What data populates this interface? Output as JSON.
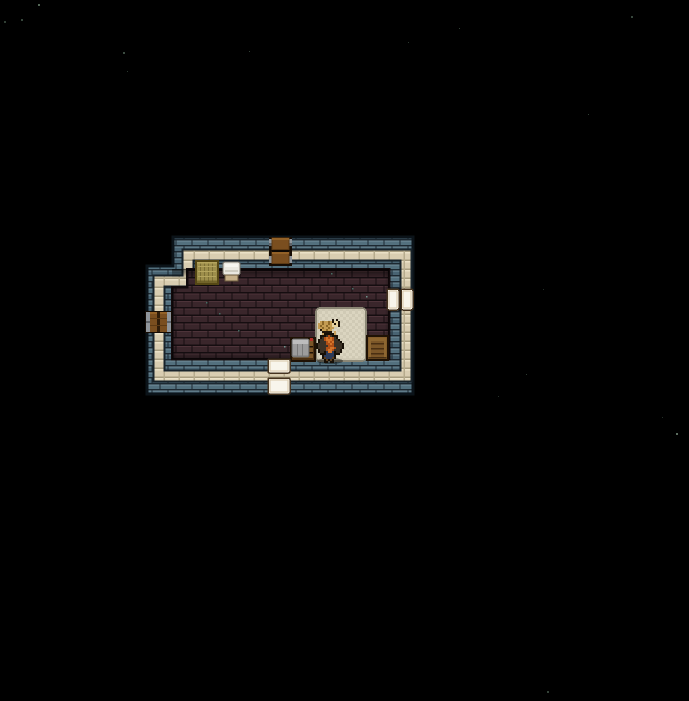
{
  "scene": {
    "background": "#000000",
    "stars": [
      {
        "x": 38,
        "y": 4,
        "s": 2,
        "c": "#5d7261",
        "o": 0.9
      },
      {
        "x": 21,
        "y": 19,
        "s": 2,
        "c": "#44584a",
        "o": 0.8
      },
      {
        "x": 4,
        "y": 21,
        "s": 2,
        "c": "#44584a",
        "o": 0.7
      },
      {
        "x": 123,
        "y": 52,
        "s": 2,
        "c": "#4a5e50",
        "o": 0.8
      },
      {
        "x": 249,
        "y": 51,
        "s": 1,
        "c": "#44584a",
        "o": 0.7
      },
      {
        "x": 127,
        "y": 71,
        "s": 1,
        "c": "#3c4f42",
        "o": 0.7
      },
      {
        "x": 459,
        "y": 28,
        "s": 1,
        "c": "#44584a",
        "o": 0.7
      },
      {
        "x": 631,
        "y": 16,
        "s": 2,
        "c": "#4a5e50",
        "o": 0.75
      },
      {
        "x": 408,
        "y": 42,
        "s": 1,
        "c": "#3c4f42",
        "o": 0.7
      },
      {
        "x": 588,
        "y": 114,
        "s": 1,
        "c": "#44584a",
        "o": 0.7
      },
      {
        "x": 543,
        "y": 289,
        "s": 1,
        "c": "#3c4f42",
        "o": 0.6
      },
      {
        "x": 526,
        "y": 374,
        "s": 1,
        "c": "#44584a",
        "o": 0.65
      },
      {
        "x": 498,
        "y": 396,
        "s": 1,
        "c": "#3c4f42",
        "o": 0.6
      },
      {
        "x": 676,
        "y": 433,
        "s": 2,
        "c": "#6b7f70",
        "o": 0.85
      },
      {
        "x": 662,
        "y": 417,
        "s": 1,
        "c": "#3c4f42",
        "o": 0.6
      },
      {
        "x": 547,
        "y": 691,
        "s": 2,
        "c": "#4a5e50",
        "o": 0.7
      }
    ],
    "room": {
      "outer_polygon": [
        [
          173,
          237
        ],
        [
          413,
          237
        ],
        [
          413,
          394
        ],
        [
          147,
          394
        ],
        [
          147,
          266
        ],
        [
          173,
          266
        ]
      ],
      "beige_ring": [
        [
          188,
          255
        ],
        [
          406,
          255
        ],
        [
          406,
          376
        ],
        [
          159,
          376
        ],
        [
          159,
          281
        ],
        [
          188,
          281
        ]
      ],
      "floor_path": "M187,269 L389,269 L389,359 L172,359 L172,287 L187,287 Z",
      "floor_specks": [
        {
          "x": 219,
          "y": 313,
          "c": "#4b7a70"
        },
        {
          "x": 284,
          "y": 346,
          "c": "#79a89e"
        },
        {
          "x": 331,
          "y": 273,
          "c": "#4b7a70"
        },
        {
          "x": 352,
          "y": 288,
          "c": "#4b7a70"
        },
        {
          "x": 366,
          "y": 296,
          "c": "#79a89e"
        },
        {
          "x": 206,
          "y": 302,
          "c": "#4b7a70"
        },
        {
          "x": 238,
          "y": 330,
          "c": "#4b7a70"
        }
      ],
      "palette": {
        "outline": "#0b1319",
        "wall_mortar": "#1c2831",
        "wall_brick": "#53707e",
        "wall_brick2": "#486372",
        "wall_brick_hi": "#74919d",
        "ring_dark": "#18232b",
        "beige": "#d9cdb1",
        "beige_hi": "#ebe1c7",
        "beige_lo": "#a89d80",
        "beige_line": "#b6ab8d",
        "floor_mortar": "#150d10",
        "floor_brick": "#3a262b",
        "floor_brick_hi": "#4d3339",
        "floor_edge": "#120a0c",
        "wood_dark": "#150c04",
        "wood": "#7a4e1f",
        "wood_hi": "#936127",
        "wood_line": "#5d3a14",
        "metal": "#8f959b",
        "metal_dark": "#5d6268",
        "white_door": "#f8f5ec",
        "door_frame": "#45331f",
        "door_inner": "#d8c7a9",
        "gap_dark": "#10161c",
        "hay1": "#9d8e4b",
        "hay_dark": "#554714",
        "hay_line": "#7d7036",
        "hay_hi": "#b5a55e",
        "chair_white": "#eae8e0",
        "chair_shade": "#cfccc0",
        "chair_base": "#c6b089",
        "chair_line": "#7a766c",
        "chair_base_line": "#6b593c",
        "mat1": "#dbd5c0",
        "mat2": "#d0cab5",
        "mat_border": "#8b8775",
        "mat_inner": "#cac4ae",
        "crate": "#7b5628",
        "crate_dark": "#1f1205",
        "crate_line": "#4a2f12",
        "crate_hi": "#8d6630",
        "shirt": "#9c9c9c",
        "shirt_hi": "#bdbdbd",
        "shirt_line": "#7a7a7a",
        "shirt_red": "#b13028"
      },
      "objects": [
        {
          "name": "hay-bale",
          "type": "hay",
          "x": 196,
          "y": 261,
          "w": 22,
          "h": 23,
          "interact": true
        },
        {
          "name": "chair",
          "type": "chair",
          "x": 222,
          "y": 262,
          "w": 19,
          "h": 19,
          "interact": true
        },
        {
          "name": "bed-mat",
          "type": "mat",
          "x": 316,
          "y": 308,
          "w": 50,
          "h": 53,
          "interact": true
        },
        {
          "name": "shirt-crate",
          "type": "shirtcrate",
          "x": 291,
          "y": 336,
          "w": 24,
          "h": 25,
          "interact": true
        },
        {
          "name": "storage-crate",
          "type": "crate",
          "x": 367,
          "y": 336,
          "w": 21,
          "h": 24,
          "interact": true
        },
        {
          "name": "top-door",
          "type": "wooddoor",
          "x": 269,
          "y": 237,
          "w": 23,
          "h": 29,
          "interact": true
        },
        {
          "name": "wall-barrel",
          "type": "barrel",
          "x": 145,
          "y": 311,
          "w": 27,
          "h": 22,
          "interact": true
        },
        {
          "name": "right-double-door",
          "type": "whitepair",
          "x": 387,
          "y": 289,
          "w": 26,
          "h": 21,
          "interact": true
        },
        {
          "name": "bottom-door",
          "type": "whitestack",
          "x": 268,
          "y": 359,
          "w": 22,
          "h": 35,
          "interact": true
        }
      ]
    },
    "sprites": {
      "character": {
        "name": "player-character",
        "x": 316,
        "y": 331,
        "cell": 2,
        "palette": {
          "D": "#171007",
          "A": "#3c3226",
          "O": "#b04f16",
          "R": "#d4752a",
          "F": "#caa15e",
          "U": "#2c3a58",
          "N": "#5d3f1f"
        },
        "grid": [
          "...F.DDD.F....",
          "...FDDDDDF....",
          "..DDDAOADDD...",
          "..DAOROROAD...",
          ".DAAORRROAAD..",
          ".DAAAORORAAAD.",
          "DAAAAOOROAAAAD",
          "DAAAAAOOOAAAAD",
          "DAAAAOORROAAAD",
          ".DAAAORROAAAD.",
          ".DAADURRUDAAD.",
          "..DDDUUUUDDD..",
          "...DUUUUUD....",
          "...DNUUUND....",
          "....DNDND.....",
          "....DD.DD....."
        ]
      },
      "cat": {
        "name": "cat",
        "x": 318,
        "y": 319,
        "cell": 2,
        "palette": {
          "T": "#c49c52",
          "M": "#8c6828",
          "W": "#e8d39f",
          "D": "#201409"
        },
        "grid": [
          ".......D.D.",
          ".TMTTMTDWWD",
          "TTMTTMTWDWD",
          "TMTTMTTWWWD",
          "TTMTTMTT...",
          ".DTTMTT....",
          "..DDDDD...."
        ]
      }
    }
  }
}
